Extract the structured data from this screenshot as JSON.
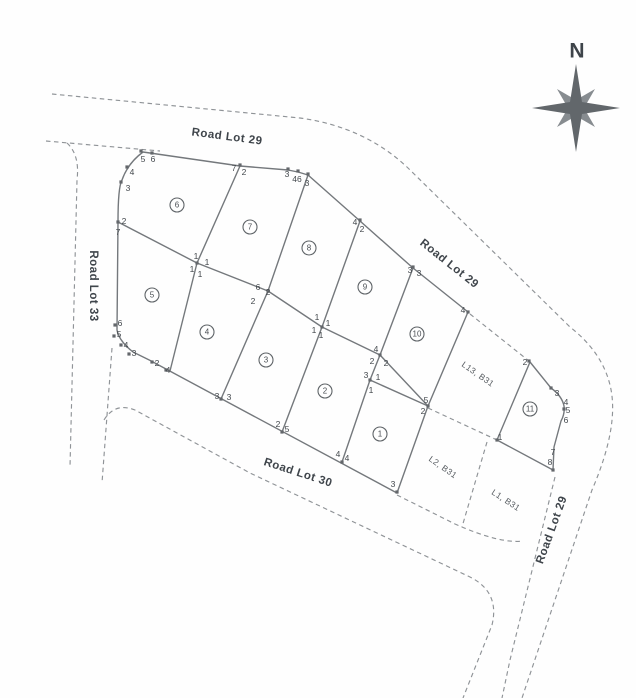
{
  "map": {
    "compass": {
      "label": "N"
    },
    "colors": {
      "paper": "#fefefe",
      "solid_line": "#74787c",
      "dashed_line": "#8f9397",
      "label_text": "#3f454b",
      "compass": "#62676b"
    },
    "road_labels": [
      {
        "text": "Road Lot 29",
        "x": 227,
        "y": 137,
        "angle": 7.5
      },
      {
        "text": "Road Lot 29",
        "x": 449,
        "y": 264,
        "angle": 38.5
      },
      {
        "text": "Road Lot 33",
        "x": 93,
        "y": 286,
        "angle": 90
      },
      {
        "text": "Road Lot 30",
        "x": 298,
        "y": 473,
        "angle": 18
      },
      {
        "text": "Road Lot 29",
        "x": 552,
        "y": 530,
        "angle": -70
      }
    ],
    "area_labels": [
      {
        "text": "L13, B31",
        "x": 478,
        "y": 374,
        "angle": 35
      },
      {
        "text": "L2, B31",
        "x": 443,
        "y": 467,
        "angle": 35
      },
      {
        "text": "L1, B31",
        "x": 506,
        "y": 500,
        "angle": 33
      }
    ],
    "lot_numbers": [
      {
        "n": "6",
        "x": 177,
        "y": 205
      },
      {
        "n": "7",
        "x": 250,
        "y": 227
      },
      {
        "n": "8",
        "x": 309,
        "y": 248
      },
      {
        "n": "9",
        "x": 365,
        "y": 287
      },
      {
        "n": "10",
        "x": 417,
        "y": 334
      },
      {
        "n": "5",
        "x": 152,
        "y": 295
      },
      {
        "n": "4",
        "x": 207,
        "y": 332
      },
      {
        "n": "3",
        "x": 266,
        "y": 360
      },
      {
        "n": "2",
        "x": 325,
        "y": 391
      },
      {
        "n": "1",
        "x": 380,
        "y": 434
      },
      {
        "n": "11",
        "x": 530,
        "y": 409
      }
    ],
    "vertex_labels": [
      {
        "t": "5",
        "x": 143,
        "y": 159
      },
      {
        "t": "6",
        "x": 153,
        "y": 159
      },
      {
        "t": "4",
        "x": 132,
        "y": 172
      },
      {
        "t": "3",
        "x": 128,
        "y": 188
      },
      {
        "t": "2",
        "x": 124,
        "y": 221
      },
      {
        "t": "7",
        "x": 118,
        "y": 232
      },
      {
        "t": "7",
        "x": 234,
        "y": 168
      },
      {
        "t": "2",
        "x": 244,
        "y": 172
      },
      {
        "t": "3",
        "x": 287,
        "y": 174
      },
      {
        "t": "46",
        "x": 297,
        "y": 179
      },
      {
        "t": "3",
        "x": 307,
        "y": 183
      },
      {
        "t": "4",
        "x": 355,
        "y": 222
      },
      {
        "t": "2",
        "x": 362,
        "y": 229
      },
      {
        "t": "3",
        "x": 410,
        "y": 270
      },
      {
        "t": "3",
        "x": 419,
        "y": 273
      },
      {
        "t": "4",
        "x": 463,
        "y": 310
      },
      {
        "t": "1",
        "x": 196,
        "y": 256
      },
      {
        "t": "1",
        "x": 207,
        "y": 262
      },
      {
        "t": "1",
        "x": 192,
        "y": 269
      },
      {
        "t": "1",
        "x": 200,
        "y": 274
      },
      {
        "t": "6",
        "x": 258,
        "y": 287
      },
      {
        "t": "2",
        "x": 268,
        "y": 292
      },
      {
        "t": "2",
        "x": 253,
        "y": 301
      },
      {
        "t": "1",
        "x": 317,
        "y": 317
      },
      {
        "t": "1",
        "x": 328,
        "y": 323
      },
      {
        "t": "1",
        "x": 314,
        "y": 330
      },
      {
        "t": "1",
        "x": 321,
        "y": 335
      },
      {
        "t": "4",
        "x": 376,
        "y": 349
      },
      {
        "t": "2",
        "x": 372,
        "y": 361
      },
      {
        "t": "2",
        "x": 386,
        "y": 363
      },
      {
        "t": "3",
        "x": 366,
        "y": 375
      },
      {
        "t": "1",
        "x": 378,
        "y": 377
      },
      {
        "t": "1",
        "x": 371,
        "y": 390
      },
      {
        "t": "5",
        "x": 426,
        "y": 400
      },
      {
        "t": "2",
        "x": 423,
        "y": 411
      },
      {
        "t": "6",
        "x": 120,
        "y": 323
      },
      {
        "t": "5",
        "x": 119,
        "y": 334
      },
      {
        "t": "4",
        "x": 126,
        "y": 345
      },
      {
        "t": "3",
        "x": 134,
        "y": 353
      },
      {
        "t": "2",
        "x": 157,
        "y": 363
      },
      {
        "t": "4",
        "x": 168,
        "y": 370
      },
      {
        "t": "3",
        "x": 217,
        "y": 396
      },
      {
        "t": "3",
        "x": 229,
        "y": 397
      },
      {
        "t": "2",
        "x": 278,
        "y": 424
      },
      {
        "t": "5",
        "x": 287,
        "y": 429
      },
      {
        "t": "4",
        "x": 338,
        "y": 454
      },
      {
        "t": "4",
        "x": 347,
        "y": 458
      },
      {
        "t": "3",
        "x": 393,
        "y": 484
      },
      {
        "t": "2",
        "x": 525,
        "y": 362
      },
      {
        "t": "3",
        "x": 557,
        "y": 393
      },
      {
        "t": "4",
        "x": 566,
        "y": 402
      },
      {
        "t": "5",
        "x": 568,
        "y": 410
      },
      {
        "t": "6",
        "x": 566,
        "y": 420
      },
      {
        "t": "1",
        "x": 500,
        "y": 437
      },
      {
        "t": "7",
        "x": 553,
        "y": 452
      },
      {
        "t": "8",
        "x": 550,
        "y": 462
      }
    ],
    "survey_points": [
      [
        141,
        151
      ],
      [
        152,
        153
      ],
      [
        127,
        167
      ],
      [
        121,
        182
      ],
      [
        118,
        222
      ],
      [
        240,
        165
      ],
      [
        288,
        169
      ],
      [
        298,
        171
      ],
      [
        308,
        174
      ],
      [
        360,
        220
      ],
      [
        413,
        267
      ],
      [
        468,
        312
      ],
      [
        115,
        325
      ],
      [
        114,
        336
      ],
      [
        121,
        345
      ],
      [
        129,
        354
      ],
      [
        152,
        362
      ],
      [
        166,
        370
      ],
      [
        197,
        263
      ],
      [
        268,
        291
      ],
      [
        322,
        327
      ],
      [
        380,
        355
      ],
      [
        370,
        380
      ],
      [
        428,
        406
      ],
      [
        221,
        399
      ],
      [
        282,
        432
      ],
      [
        342,
        462
      ],
      [
        397,
        492
      ],
      [
        529,
        361
      ],
      [
        551,
        388
      ],
      [
        564,
        409
      ],
      [
        553,
        470
      ],
      [
        497,
        440
      ]
    ]
  }
}
